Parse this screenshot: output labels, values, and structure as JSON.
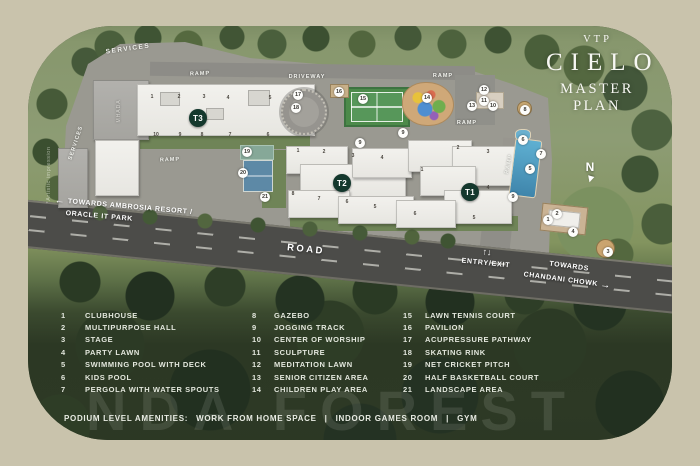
{
  "title": {
    "brand": "VTP",
    "name": "CIELO",
    "subtitle": "MASTER PLAN"
  },
  "map": {
    "labels": {
      "services_top": "SERVICES",
      "services_side": "SERVICES",
      "mhada": "MHADA",
      "ramp": "RAMP",
      "driveway": "DRIVEWAY",
      "road": "ROAD",
      "entry_exit": "ENTRY/EXIT",
      "entry_arrows": "↑↓",
      "towards_left_arrow": "←",
      "towards_left_line1": "TOWARDS AMBROSIA RESORT /",
      "towards_left_line2": "ORACLE IT PARK",
      "towards_right_line1": "TOWARDS",
      "towards_right_line2": "CHANDANI CHOWK",
      "towards_right_arrow": "→",
      "north": "N",
      "artistic_note": "*Artistic impression"
    },
    "towers": [
      "T3",
      "T2",
      "T1"
    ],
    "markers": [
      "17",
      "18",
      "16",
      "15",
      "14",
      "12",
      "11",
      "13",
      "10",
      "8",
      "6",
      "7",
      "5",
      "9",
      "9",
      "9",
      "19",
      "20",
      "21",
      "2",
      "1",
      "4",
      "3"
    ],
    "unit_labels": [
      "1",
      "2",
      "3",
      "4",
      "5",
      "10",
      "9",
      "8",
      "7",
      "6",
      "1",
      "2",
      "3",
      "4",
      "8",
      "7",
      "6",
      "5",
      "2",
      "3",
      "1",
      "4",
      "6",
      "5"
    ]
  },
  "legend": {
    "columns": [
      [
        {
          "num": "1",
          "label": "CLUBHOUSE"
        },
        {
          "num": "2",
          "label": "MULTIPURPOSE HALL"
        },
        {
          "num": "3",
          "label": "STAGE"
        },
        {
          "num": "4",
          "label": "PARTY LAWN"
        },
        {
          "num": "5",
          "label": "SWIMMING POOL WITH DECK"
        },
        {
          "num": "6",
          "label": "KIDS POOL"
        },
        {
          "num": "7",
          "label": "PERGOLA WITH WATER SPOUTS"
        }
      ],
      [
        {
          "num": "8",
          "label": "GAZEBO"
        },
        {
          "num": "9",
          "label": "JOGGING TRACK"
        },
        {
          "num": "10",
          "label": "CENTER OF WORSHIP"
        },
        {
          "num": "11",
          "label": "SCULPTURE"
        },
        {
          "num": "12",
          "label": "MEDITATION LAWN"
        },
        {
          "num": "13",
          "label": "SENIOR CITIZEN AREA"
        },
        {
          "num": "14",
          "label": "CHILDREN PLAY AREA"
        }
      ],
      [
        {
          "num": "15",
          "label": "LAWN TENNIS COURT"
        },
        {
          "num": "16",
          "label": "PAVILION"
        },
        {
          "num": "17",
          "label": "ACUPRESSURE PATHWAY"
        },
        {
          "num": "18",
          "label": "SKATING RINK"
        },
        {
          "num": "19",
          "label": "NET CRICKET PITCH"
        },
        {
          "num": "20",
          "label": "HALF BASKETBALL COURT"
        },
        {
          "num": "21",
          "label": "LANDSCAPE AREA"
        }
      ]
    ]
  },
  "footer": {
    "prefix": "PODIUM LEVEL AMENITIES:",
    "separator": "|",
    "items": [
      "WORK FROM HOME SPACE",
      "INDOOR GAMES ROOM",
      "GYM"
    ]
  },
  "watermark": "NDA FOREST",
  "colors": {
    "frame": "#c9c3ac",
    "badge_green": "#14382d",
    "marker_bg": "#fdfdfb",
    "legend_text": "#e3e7dd",
    "tennis_green": "#4c8a4a",
    "pool_blue": "#4f9cc0",
    "basketball_blue": "#5d89a6",
    "road_gray": "#4c4c49"
  }
}
